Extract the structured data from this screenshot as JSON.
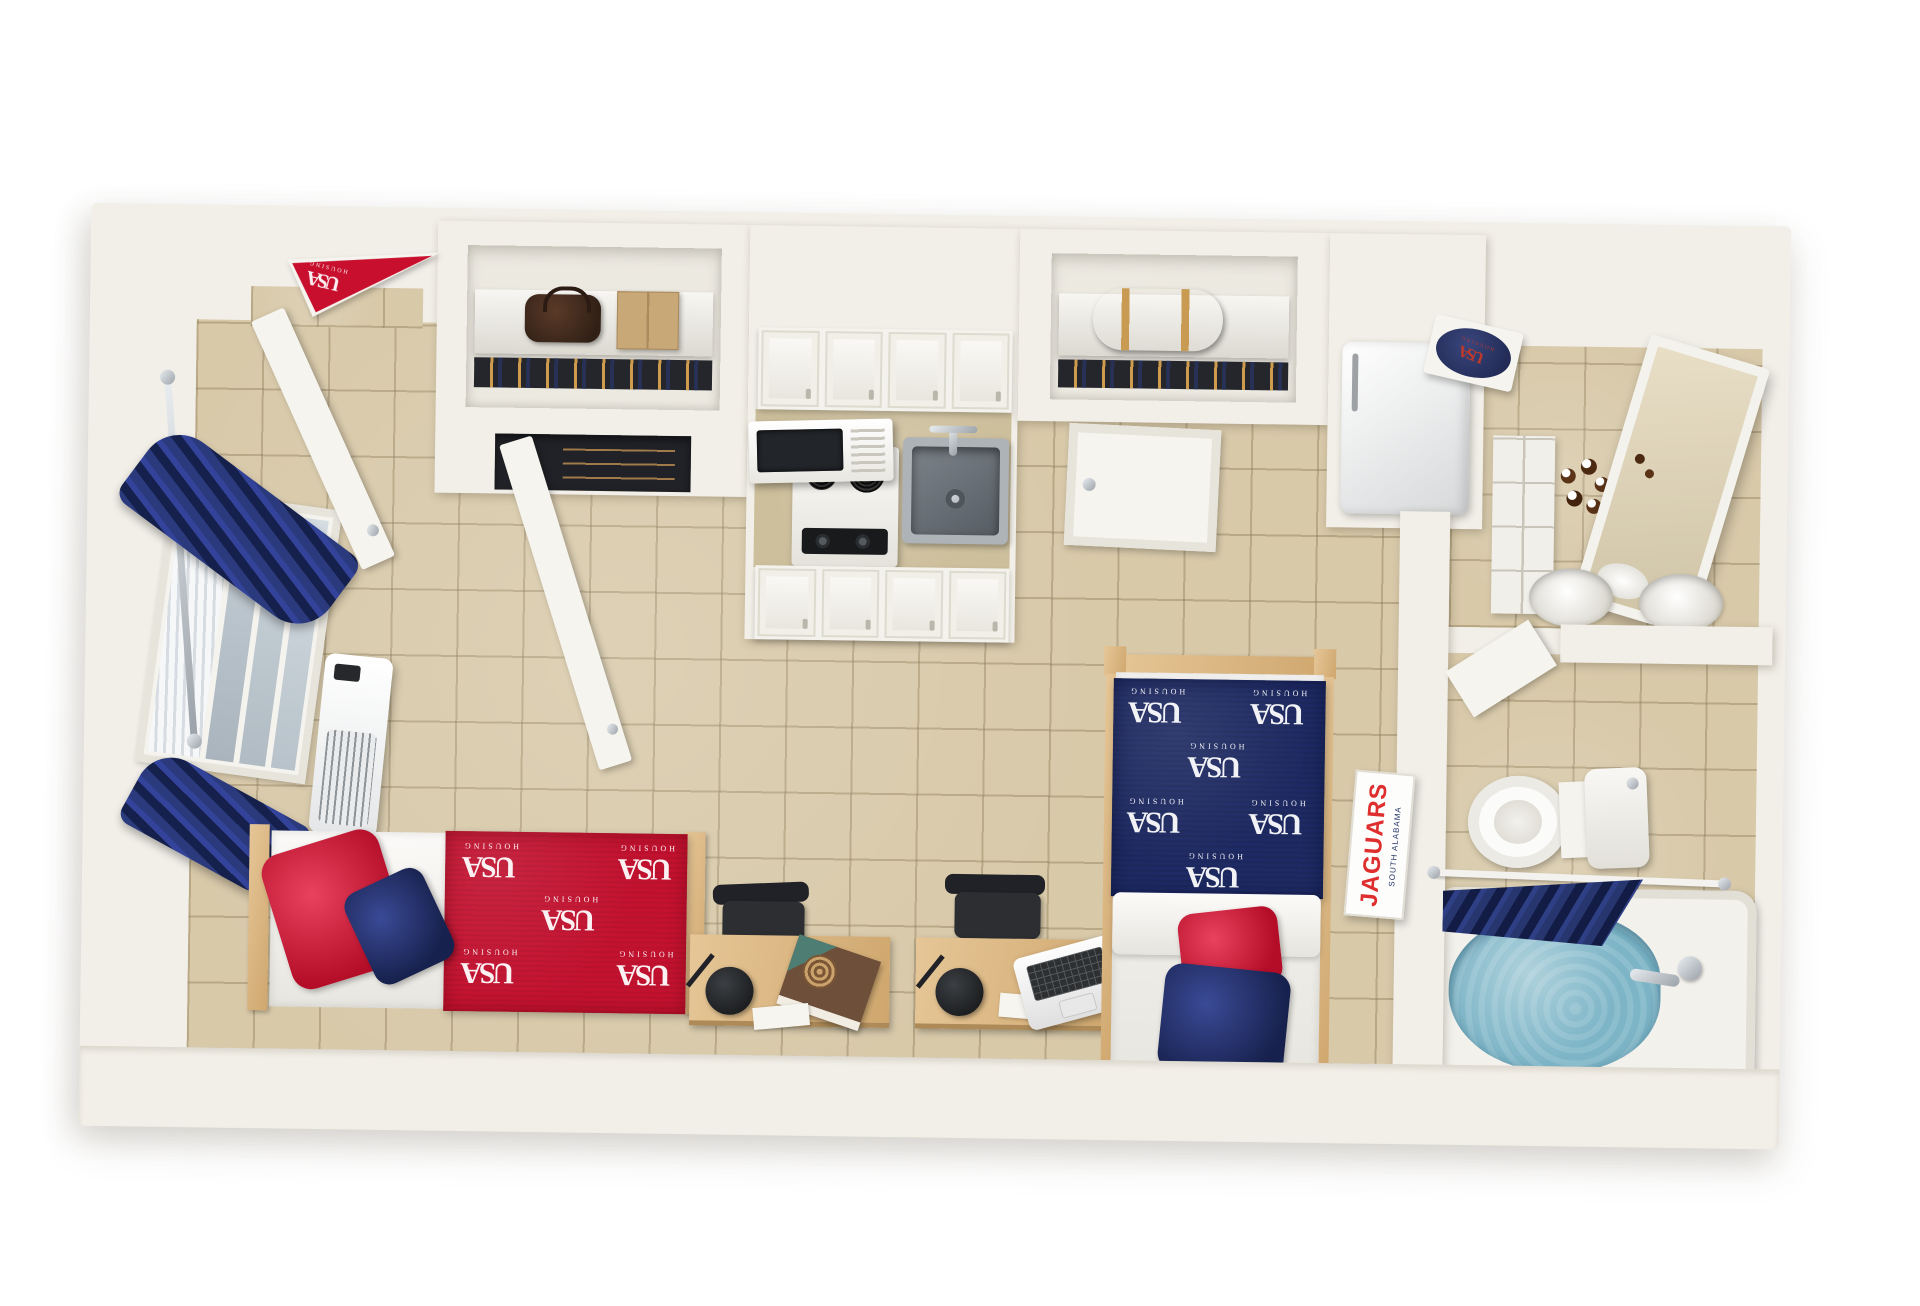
{
  "scene": {
    "title": "USA Housing studio apartment — 3D top-down floor plan rendering",
    "branding": {
      "monogram": "USA",
      "wordmark": "HOUSING"
    },
    "colors": {
      "brand_red": "#C8102E",
      "brand_navy": "#212F66",
      "wall": "#F2EFE8",
      "floor_tile": "#D8C9A9",
      "wood": "#D9BA8C",
      "bath_water": "#7DB5C7",
      "bedding_red": "#C31230",
      "bedding_navy": "#1E2A63"
    },
    "signs": {
      "door_pennant": {
        "monogram": "USA",
        "wordmark": "HOUSING"
      },
      "wall_plaque": {
        "monogram": "USA",
        "wordmark": "HOUSING"
      },
      "jaguars_banner": {
        "subtitle": "SOUTH ALABAMA",
        "title": "JAGUARS"
      }
    },
    "areas": {
      "entry": [
        "open entry door",
        "USA Housing pennant"
      ],
      "closet_left": [
        "shelf with brown handbag",
        "cardboard storage box",
        "hanging clothes",
        "wood dresser",
        "open closet door"
      ],
      "kitchenette": [
        "upper cabinets",
        "microwave",
        "two-burner range",
        "stainless sink with faucet",
        "tan counter",
        "lower cabinets"
      ],
      "closet_right": [
        "shelf with brown duffel bag",
        "hanging clothes",
        "closed interior door"
      ],
      "appliances": [
        "refrigerator"
      ],
      "living_area": [
        "window with blinds",
        "navy curtain panels",
        "wall air-conditioner",
        "twin bed with red USA Housing comforter",
        "red pillow",
        "navy pillow",
        "two wood desks",
        "two black desk chairs",
        "two black desk lamps",
        "books",
        "white laptop",
        "twin bed with navy USA Housing comforter"
      ],
      "vanity": [
        "white storage drawers",
        "toiletry bottles",
        "leaning framed mirror",
        "round sink basins",
        "USA Housing wall plaque"
      ],
      "bathroom": [
        "corner shelf",
        "toilet",
        "shower rod",
        "navy shower curtain",
        "bathtub filled with blue water",
        "chrome tub faucet",
        "Jaguars banner"
      ]
    }
  }
}
